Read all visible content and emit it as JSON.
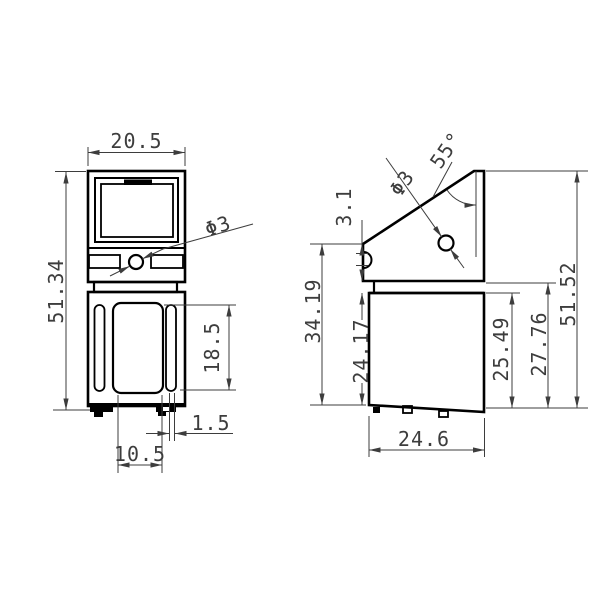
{
  "drawing_type": "engineering-orthographic-drawing",
  "views": {
    "front": {
      "dims": {
        "width": "20.5",
        "height": "51.34",
        "hole": "Φ3",
        "panel_height": "18.5",
        "slot_offset": "1.5",
        "foot_span": "10.5"
      }
    },
    "side": {
      "dims": {
        "angle": "55°",
        "hole": "Φ3",
        "notch_offset": "3.1",
        "upper_height": "34.19",
        "box_height": "24.17",
        "inner_height": "25.49",
        "mid_height": "27.76",
        "total_height": "51.52",
        "depth": "24.6"
      }
    }
  },
  "colors": {
    "outline": "#000000",
    "dimension": "#3d3d3d",
    "background": "#ffffff"
  }
}
